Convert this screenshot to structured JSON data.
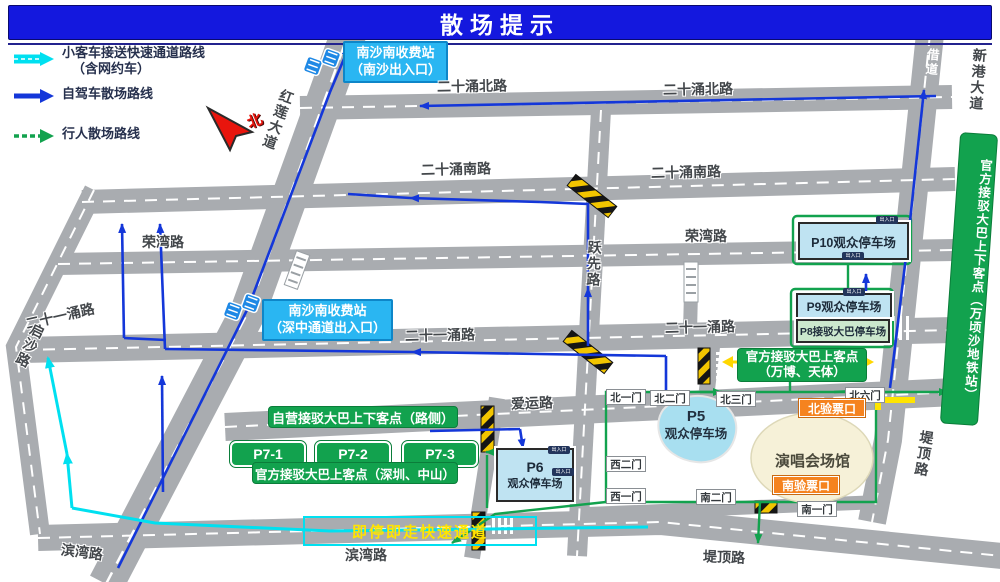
{
  "title": "散场提示",
  "legend": {
    "items": [
      {
        "icon": "cyan-express-arrow",
        "label": "小客车接送快速通道路线",
        "label2": "（含网约车）"
      },
      {
        "icon": "blue-selfdrive-arrow",
        "label": "自驾车散场路线"
      },
      {
        "icon": "green-pedestrian-arrow",
        "label": "行人散场路线"
      }
    ]
  },
  "compass": "北",
  "tolls": {
    "north": {
      "name": "南沙南收费站",
      "sub": "（南沙出入口）"
    },
    "south": {
      "name": "南沙南收费站",
      "sub": "（深中通道出入口）"
    }
  },
  "roads": {
    "ershiyong_north": "二十涌北路",
    "ershiyong_south": "二十涌南路",
    "rongwan": "荣湾路",
    "ershiyiyong": "二十一涌路",
    "yuexian": "跃先路",
    "aiyun": "爱运路",
    "qisha": "启沙路",
    "binwan": "滨湾路",
    "diding": "堤顶路",
    "honglian": "红莲大道",
    "xingang": "新港大道",
    "jiedao": "借道"
  },
  "parking": {
    "p10": "P10观众停车场",
    "p9": "P9观众停车场",
    "p8": "P8接驳大巴停车场",
    "p5": {
      "code": "P5",
      "label": "观众停车场"
    },
    "p6": {
      "code": "P6",
      "label": "观众停车场"
    },
    "p7": [
      "P7-1",
      "P7-2",
      "P7-3"
    ],
    "badge": "出入口"
  },
  "stops": {
    "metro": "官方接驳大巴上下客点（万顷沙地铁站）",
    "wanbo": {
      "line1": "官方接驳大巴上客点",
      "line2": "（万博、天体）"
    },
    "roadside": "自营接驳大巴上下客点（路侧）",
    "shenzhen_zhongshan": "官方接驳大巴上客点（深圳、中山）",
    "express": "即停即走快速通道"
  },
  "venue": {
    "name": "演唱会场馆",
    "gates": [
      "北一门",
      "北二门",
      "北三门",
      "北六门",
      "西二门",
      "西一门",
      "南二门",
      "南一门"
    ],
    "checkpoint_north": "北验票口",
    "checkpoint_south": "南验票口"
  },
  "colors": {
    "title_bg": "#1418DE",
    "route_car_express": "#00E0F0",
    "route_self_drive": "#1437D9",
    "route_pedestrian": "#12A24E",
    "toll_label_bg": "#2AB6F2",
    "stop_green": "#12A24E",
    "checkpoint_orange": "#F5831F",
    "parking_blue": "#BFE3F2",
    "parking_green": "#CBE8CD",
    "express_text": "#FFE400",
    "road_gray": "#A9ACB0"
  }
}
